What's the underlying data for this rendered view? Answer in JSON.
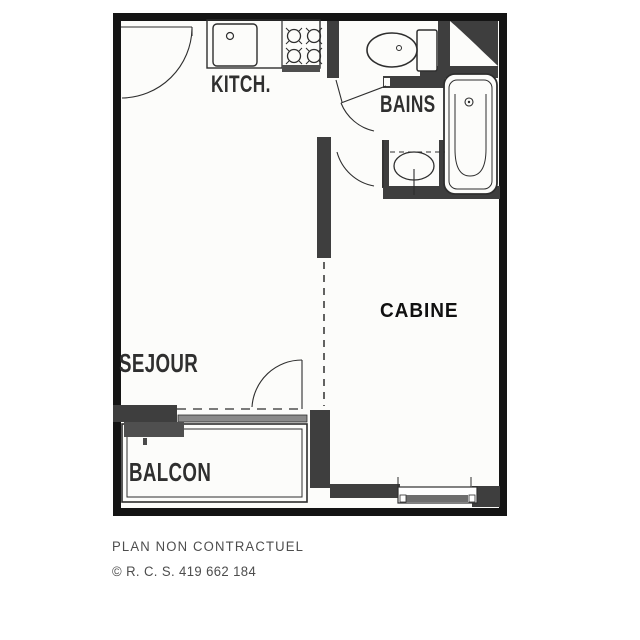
{
  "plan": {
    "rooms": {
      "kitchen": "KITCH.",
      "bathroom": "BAINS",
      "cabin": "CABINE",
      "living": "SEJOUR",
      "balcony": "BALCON"
    },
    "footer": {
      "disclaimer": "PLAN NON CONTRACTUEL",
      "registration": "© R. C. S. 419 662 184"
    },
    "colors": {
      "frame": "#141414",
      "wall": "#3e3e3e",
      "line": "#2e2e2e",
      "paper": "#fcfcfa",
      "label_text": "#2f2f2f",
      "footer_text": "#4d4d4d"
    }
  }
}
